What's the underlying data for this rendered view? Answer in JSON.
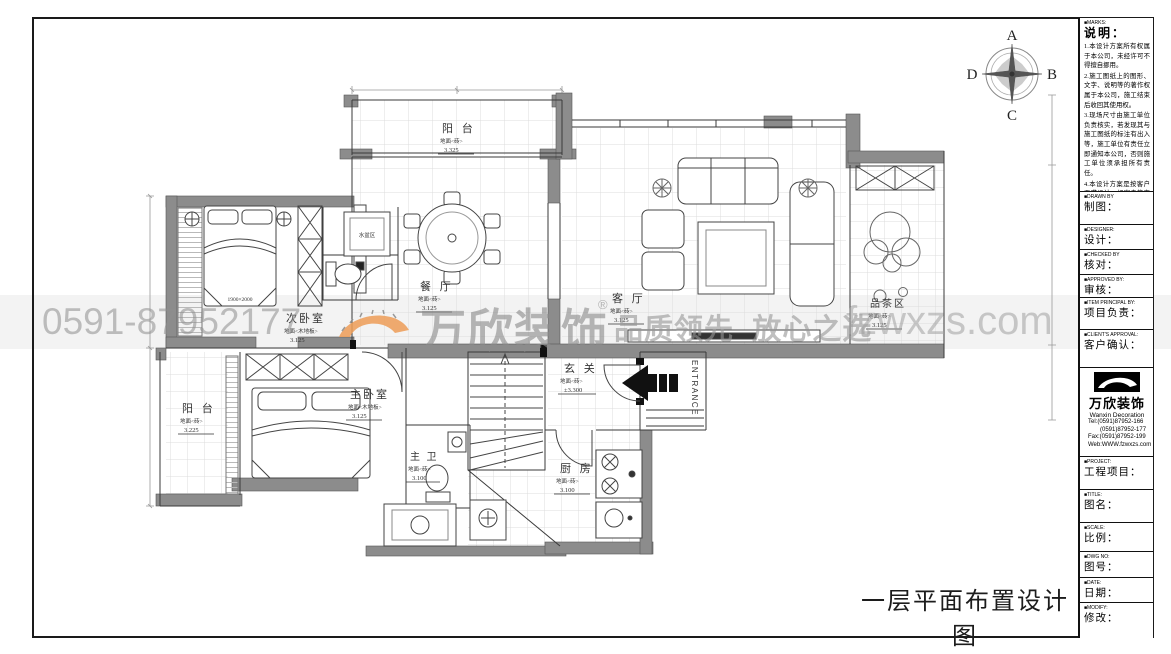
{
  "caption": "一层平面布置设计图",
  "compass": {
    "top": "A",
    "right": "B",
    "bottom": "C",
    "left": "D"
  },
  "watermark": {
    "phone": "0591-87952177",
    "brand": "万欣装饰",
    "reg_mark": "®",
    "slogan": "品质领先 放心之选",
    "website": "fzwxzs.com"
  },
  "plan": {
    "rooms": [
      {
        "name": "阳 台",
        "finish": "地面<砖>",
        "level": "3.325"
      },
      {
        "name": "餐 厅",
        "finish": "地面<砖>",
        "level": "3.125"
      },
      {
        "name": "客 厅",
        "finish": "地面<砖>",
        "level": "3.125"
      },
      {
        "name": "品茶区",
        "finish": "地面<砖>",
        "level": "3.125"
      },
      {
        "name": "次卧室",
        "finish": "地面<木地板>",
        "level": "3.125"
      },
      {
        "name": "阳 台",
        "finish": "地面<砖>",
        "level": "3.225"
      },
      {
        "name": "主卧室",
        "finish": "地面<木地板>",
        "level": "3.125"
      },
      {
        "name": "主 卫",
        "finish": "地面<砖>",
        "level": "3.100"
      },
      {
        "name": "玄 关",
        "finish": "地面<砖>",
        "level": "±3.300"
      },
      {
        "name": "厨 房",
        "finish": "地面<砖>",
        "level": "3.100"
      }
    ],
    "annotations": {
      "basin_area": "水盆区",
      "bed_size": "1900×2000",
      "entrance": "ENTRANCE"
    }
  },
  "titleblock": {
    "marks_en": "■MARKS:",
    "marks_cn": "说明：",
    "notes": [
      "1.本设计方案所有权属于本公司，未经许可不得擅自挪用。",
      "2.施工图纸上的图形、文字、说明等的著作权属于本公司，施工结束后收回其使用权。",
      "3.现场尺寸由施工单位负责核实，若发现其与施工图纸的标注有出入等，施工单位有责任立即通知本公司，否则施工单位须承担所有责任。",
      "4.本设计方案是按客户要求设计，经客户签字即视为同意认可，不得随意更改。"
    ],
    "fields": [
      {
        "en": "■DRAWN BY",
        "cn": "制图："
      },
      {
        "en": "■DESIGNER:",
        "cn": "设计："
      },
      {
        "en": "■CHECKED BY",
        "cn": "核对："
      },
      {
        "en": "■APPROVED BY:",
        "cn": "审核："
      },
      {
        "en": "■ITEM PRINCIPAL BY:",
        "cn": "项目负责："
      },
      {
        "en": "■CLIENT'S APPROVAL:",
        "cn": "客户确认："
      }
    ],
    "company": {
      "brand": "万欣装饰",
      "brand_sub": "Wanxin Decoration",
      "tel1": "Tel:(0591)87952-166",
      "tel2": "(0591)87952-177",
      "fax": "Fax:(0591)87952-199",
      "web": "Web:WWW.fzwxzs.com"
    },
    "fields2": [
      {
        "en": "■PROJECT:",
        "cn": "工程项目："
      },
      {
        "en": "■TITLE:",
        "cn": "图名："
      },
      {
        "en": "■SCALE:",
        "cn": "比例："
      },
      {
        "en": "■DWG NO:",
        "cn": "图号："
      },
      {
        "en": "■DATE:",
        "cn": "日期："
      },
      {
        "en": "■MODIFY:",
        "cn": "修改："
      }
    ]
  }
}
